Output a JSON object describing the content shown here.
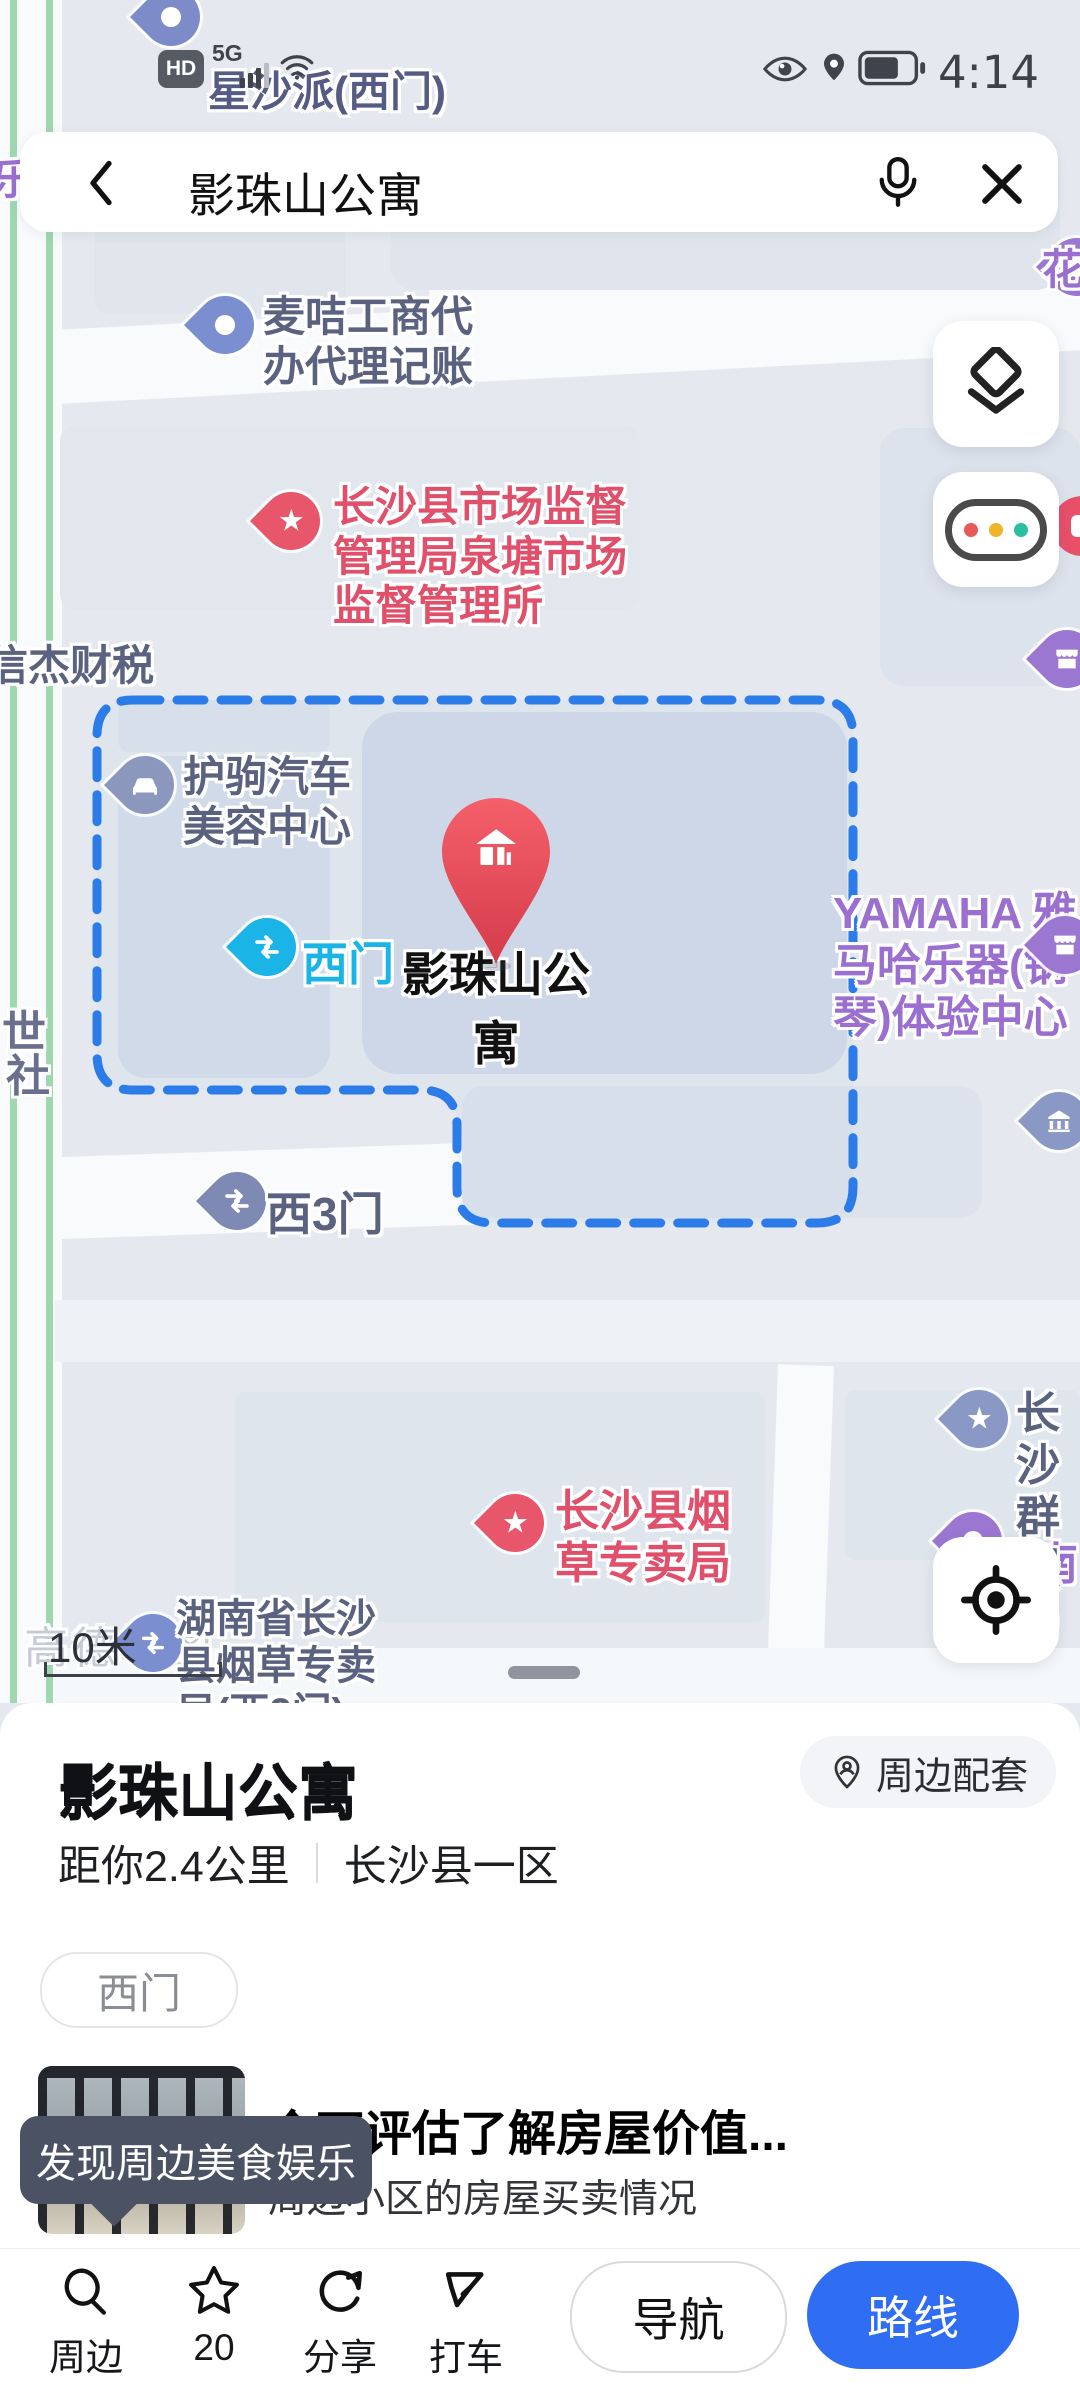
{
  "status_bar": {
    "hd_badge": "HD",
    "network": "5G",
    "time": "4:14"
  },
  "search_bar": {
    "query": "影珠山公寓"
  },
  "map": {
    "scale_label": "10米",
    "watermark": "高德地图",
    "pois": {
      "xingshapai": "星沙派(西门)",
      "le_edge": "乐",
      "hua_edge": "花",
      "maiji": "麦咭工商代\n办代理记账",
      "market_bureau": "长沙县市场监督\n管理局泉塘市场\n监督管理所",
      "xinjie": "信杰财税",
      "huju": "护驹汽车\n美容中心",
      "west_gate": "西门",
      "main_poi": "影珠山公寓",
      "yamaha": "YAMAHA 雅\n马哈乐器(钢\n琴)体验中心",
      "shi_edge": "世",
      "she_edge": "社",
      "west_gate3": "西3门",
      "qunfu": "长沙\n群服",
      "nan6": "南6",
      "tobacco": "长沙县烟\n草专卖局",
      "tobacco_west2": "湖南省长沙\n县烟草专卖\n局(西2门)"
    }
  },
  "panel": {
    "title": "影珠山公寓",
    "distance": "距你2.4公里",
    "area": "长沙县一区",
    "surroundings_button": "周边配套",
    "gate_tag": "西门",
    "promo_title": "全面评估了解房屋价值...",
    "promo_subtitle": "周边小区的房屋买卖情况",
    "discover_bubble": "发现周边美食娱乐"
  },
  "toolbar": {
    "nearby": "周边",
    "favorites_count": "20",
    "share": "分享",
    "taxi": "打车",
    "navigate": "导航",
    "route": "路线"
  },
  "colors": {
    "route_button_blue": "#2f6df2",
    "selection_dash_blue": "#2b7ce9",
    "main_pin_red": "#e8404f",
    "poi_red": "#e5566c",
    "poi_purple": "#9a6fd0",
    "gate_cyan": "#1ab5e6",
    "poi_slate_blue": "#7b8ed0",
    "label_slate": "#5b6280"
  }
}
